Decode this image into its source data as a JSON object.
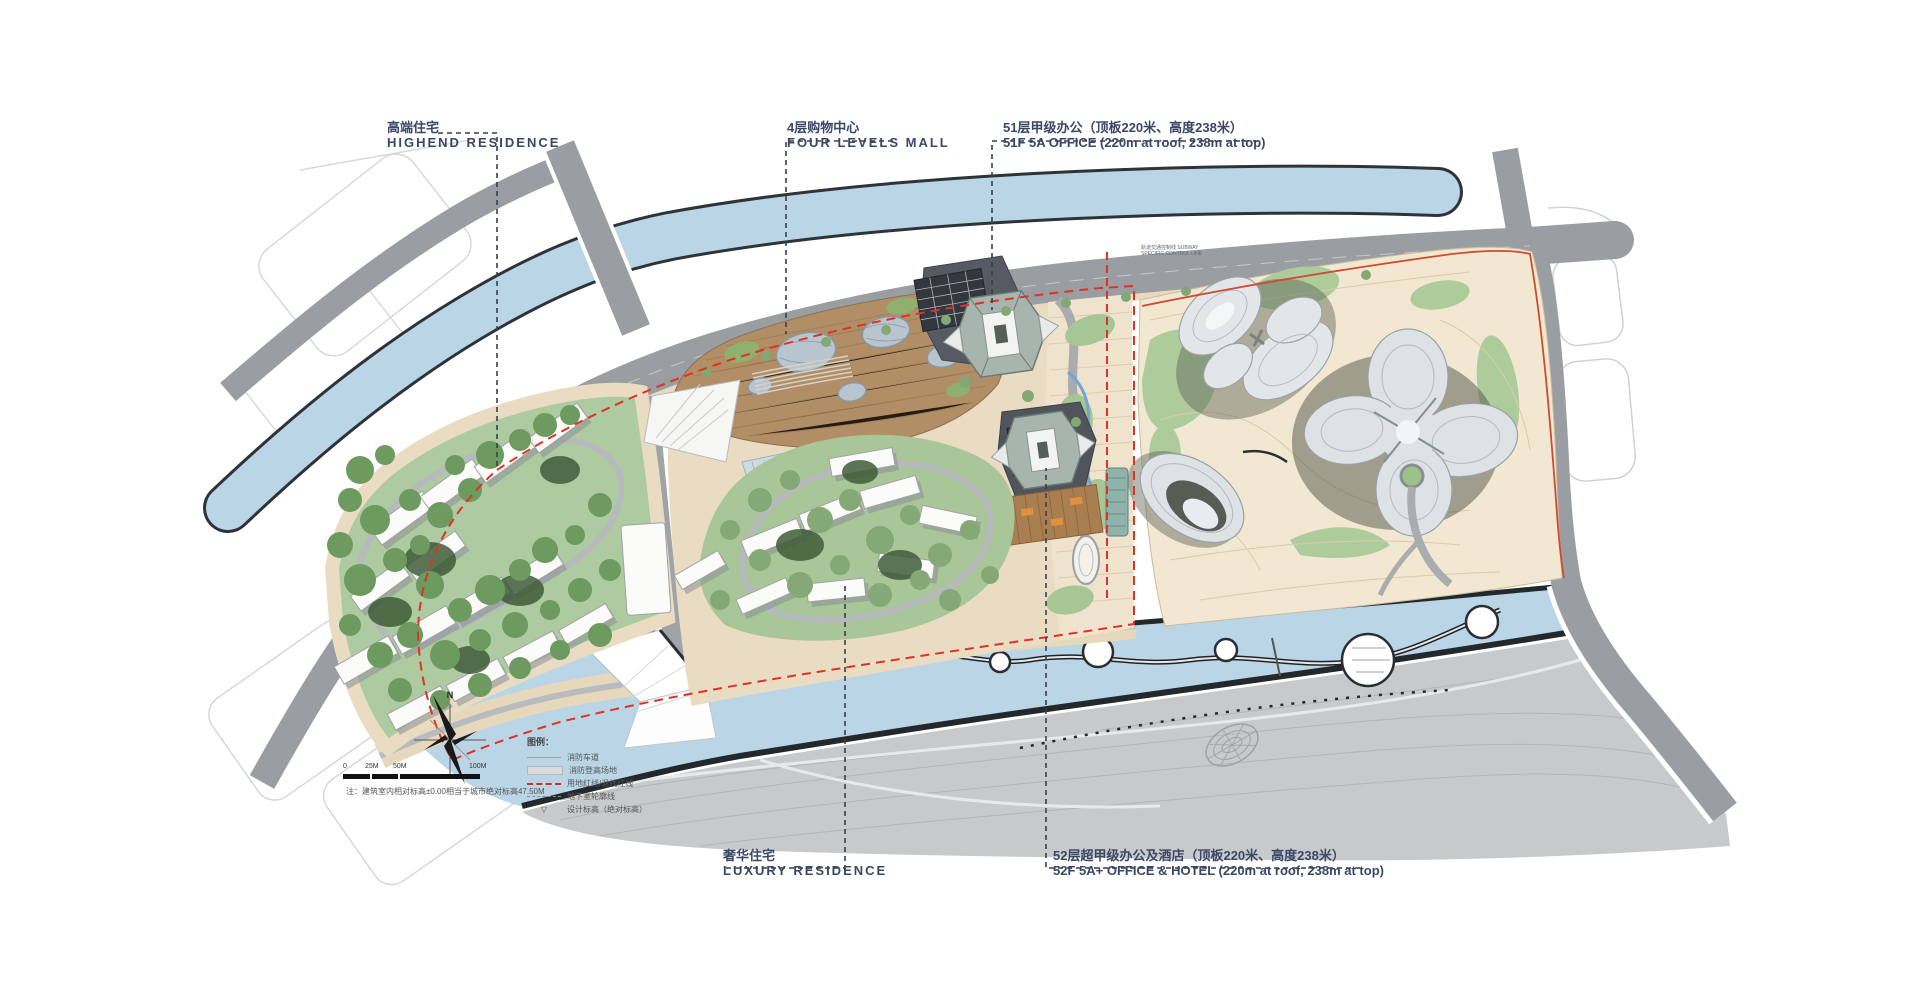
{
  "plan": {
    "annotations": {
      "highend_residence": {
        "zh": "高端住宅",
        "en": "HIGHEND RESIDENCE"
      },
      "four_levels_mall": {
        "zh": "4层购物中心",
        "en": "FOUR LEVELS MALL"
      },
      "office_51f": {
        "zh": "51层甲级办公（顶板220米、高度238米）",
        "en": "51F 5A OFFICE (220m at roof, 238m at top)"
      },
      "luxury_residence": {
        "zh": "奢华住宅",
        "en": "LUXURY RESIDENCE"
      },
      "office_52f": {
        "zh": "52层超甲级办公及酒店（顶板220米、高度238米）",
        "en": "52F 5A+ OFFICE & HOTEL (220m at roof, 238m at top)"
      }
    },
    "subway_control_note": "轨道交通控制线 SUBWAY SPECIFIC CONTROL LINE",
    "legend": {
      "title": "图例：",
      "items": [
        {
          "label": "消防车道",
          "swatch": "gray-line"
        },
        {
          "label": "消防登高场地",
          "swatch": "gray-fill"
        },
        {
          "label": "用地红线/退线红线",
          "swatch": "red-dashed-line"
        },
        {
          "label": "地下室轮廓线",
          "swatch": "gray-dashed-line"
        },
        {
          "label": "设计标高（绝对标高）",
          "swatch": "elevation-marker",
          "glyph": "▽"
        }
      ]
    },
    "note": "注：建筑室内相对标高±0.00相当于城市绝对标高47.50M",
    "compass": {
      "north_label": "N"
    },
    "scale_bar": {
      "ticks": [
        "0",
        "25M",
        "50M",
        "100M"
      ]
    },
    "colors": {
      "water": "#b9d5e6",
      "road": "#9a9ea2",
      "site_green": "#aecaa0",
      "park_ground": "#f2e7d0",
      "mall_deck": "#b18e66",
      "red_line": "#e03224",
      "annotation_text": "#3b4766"
    }
  }
}
